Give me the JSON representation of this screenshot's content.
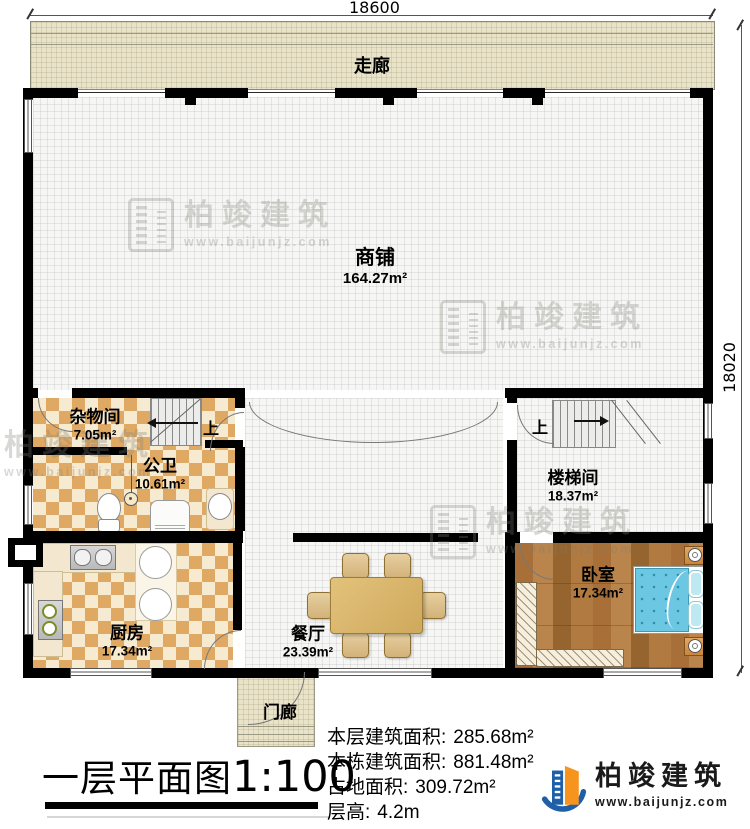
{
  "dimensions": {
    "top": "18600",
    "right": "18020"
  },
  "corridor": {
    "label": "走廊"
  },
  "rooms": {
    "shop": {
      "label": "商铺",
      "area": "164.27m²"
    },
    "storage": {
      "label": "杂物间",
      "area": "7.05m²"
    },
    "bathroom": {
      "label": "公卫",
      "area": "10.61m²"
    },
    "kitchen": {
      "label": "厨房",
      "area": "17.34m²"
    },
    "dining": {
      "label": "餐厅",
      "area": "23.39m²"
    },
    "stairwell": {
      "label": "楼梯间",
      "area": "18.37m²"
    },
    "bedroom": {
      "label": "卧室",
      "area": "17.34m²"
    },
    "porch": {
      "label": "门廊"
    }
  },
  "stairs": {
    "up_label_left": "上",
    "up_label_right": "上"
  },
  "title": {
    "text": "一层平面图",
    "scale": "1:100"
  },
  "stats": [
    {
      "label": "本层建筑面积:",
      "value": "285.68m²"
    },
    {
      "label": "本栋建筑面积:",
      "value": "881.48m²"
    },
    {
      "label": "占地面积:",
      "value": "309.72m²"
    },
    {
      "label": "层高:",
      "value": "4.2m"
    }
  ],
  "brand": {
    "name": "柏竣建筑",
    "url": "www.baijunjz.com"
  },
  "watermark": {
    "name": "柏竣建筑",
    "url": "www.baijunjz.com"
  },
  "colors": {
    "wall": "#000000",
    "checker_dark": "#e0a963",
    "checker_light": "#f6ead0",
    "corridor_bg": "#e9e3c9",
    "wood": "#a87038",
    "bed_blue": "#6cc7e2",
    "logo_blue": "#1e5fa8",
    "logo_orange": "#f7941e"
  }
}
